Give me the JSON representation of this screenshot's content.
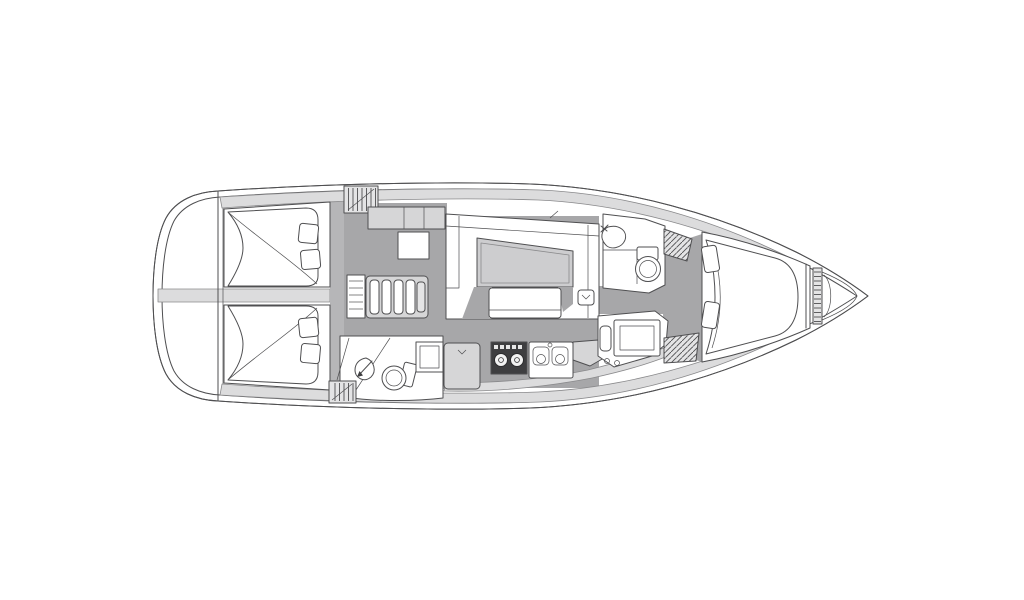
{
  "diagram": {
    "type": "floor-plan",
    "subject": "sailboat-interior-layout",
    "orientation": "bow-right",
    "text_labels": []
  },
  "colors": {
    "background": "#ffffff",
    "line": "#4f4f51",
    "line_light": "#8a8a8c",
    "floor": "#a7a7a9",
    "deck": "#dcdcdd",
    "furniture": "#d6d6d7",
    "wall": "#b6b6b8",
    "table": "#cdcdcf",
    "appliance": "#3e3e40",
    "bed": "#ffffff",
    "hatch_fill": "#e4e4e5"
  },
  "elements": [
    {
      "name": "hull-outline",
      "kind": "boundary"
    },
    {
      "name": "swim-platform",
      "kind": "area"
    },
    {
      "name": "aft-cabin-port",
      "kind": "cabin",
      "features": [
        "double-berth",
        "two-pillows"
      ]
    },
    {
      "name": "aft-cabin-starboard",
      "kind": "cabin",
      "features": [
        "double-berth",
        "two-pillows"
      ]
    },
    {
      "name": "companionway-stairs",
      "kind": "stairs",
      "steps": 4
    },
    {
      "name": "companionway-hatch",
      "kind": "hatch"
    },
    {
      "name": "aft-head",
      "kind": "bathroom",
      "features": [
        "shower-drain",
        "toilet",
        "sink-counter"
      ]
    },
    {
      "name": "salon-settee",
      "kind": "seating"
    },
    {
      "name": "salon-table",
      "kind": "table"
    },
    {
      "name": "salon-bench",
      "kind": "seating"
    },
    {
      "name": "storage-cabinet",
      "kind": "cabinet"
    },
    {
      "name": "chart-table",
      "kind": "table"
    },
    {
      "name": "galley",
      "kind": "kitchen",
      "features": [
        "fridge",
        "stove-two-burners",
        "double-sink",
        "counter"
      ]
    },
    {
      "name": "nav-station",
      "kind": "desk"
    },
    {
      "name": "forward-head",
      "kind": "bathroom",
      "features": [
        "sink",
        "toilet"
      ]
    },
    {
      "name": "corridor",
      "kind": "passage"
    },
    {
      "name": "deck-hatch-lockers",
      "kind": "hatch",
      "count": 4
    },
    {
      "name": "forward-cabin",
      "kind": "cabin",
      "features": [
        "v-berth",
        "two-pillows"
      ]
    },
    {
      "name": "anchor-locker",
      "kind": "locker"
    },
    {
      "name": "bow",
      "kind": "boundary"
    }
  ]
}
